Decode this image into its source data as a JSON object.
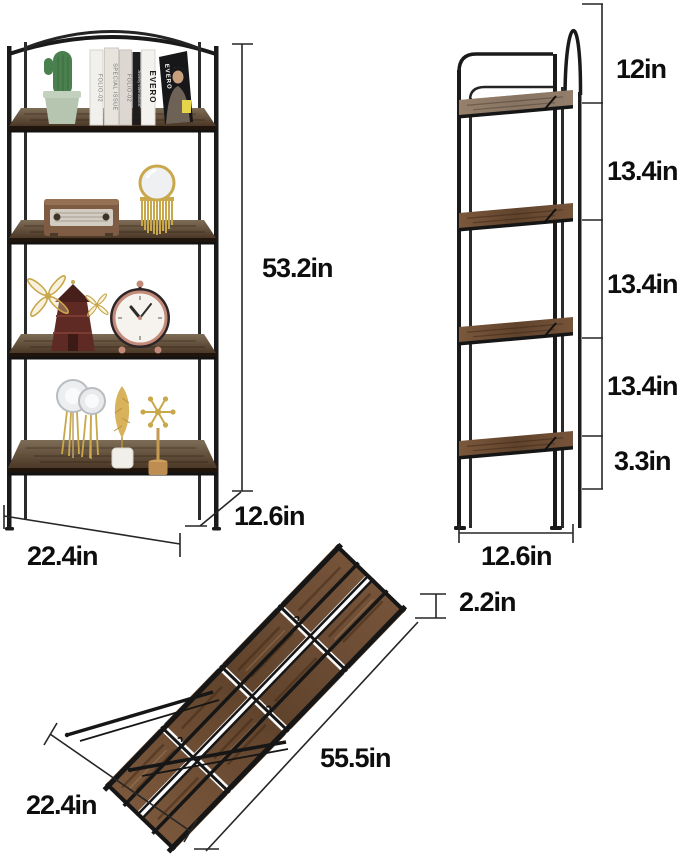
{
  "product": {
    "name": "4-Tier Folding Bookshelf",
    "image_type": "product-dimension-diagram"
  },
  "front_view": {
    "height": "53.2in",
    "width": "22.4in",
    "depth": "12.6in",
    "decor": {
      "books": [
        "FOLIO-02",
        "SPECIAL ISSUE",
        "FOLIO-02",
        "Jewelry International",
        "EVERO"
      ],
      "magazine": "EVERO"
    }
  },
  "side_view": {
    "shelf_gaps": [
      "12in",
      "13.4in",
      "13.4in",
      "13.4in",
      "3.3in"
    ],
    "depth": "12.6in"
  },
  "folded_view": {
    "thickness": "2.2in",
    "length": "55.5in",
    "width": "22.4in"
  },
  "colors": {
    "frame": "#1a1a1a",
    "shelf_wood": "#5a4430",
    "folded_wood": "#6e4e36",
    "dimension_line": "#262626",
    "label_text": "#0e0e0e",
    "background": "#ffffff"
  }
}
